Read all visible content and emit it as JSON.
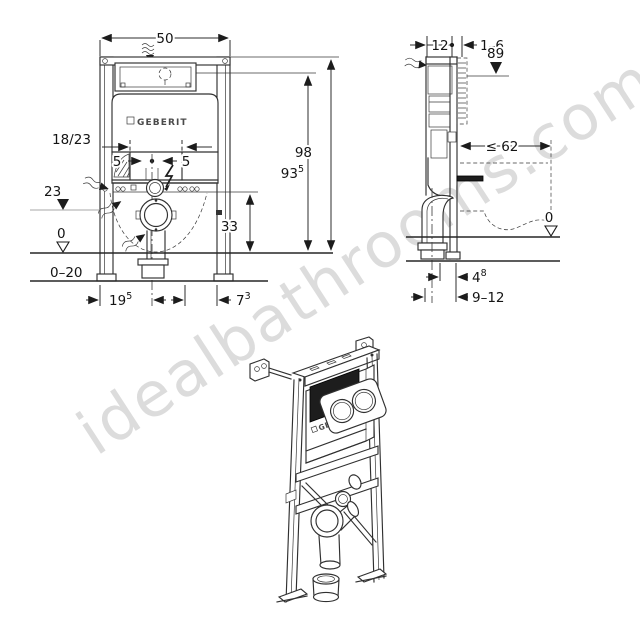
{
  "watermark": {
    "text": "idealbathrooms.com"
  },
  "brand": {
    "logo": "GEBERIT"
  },
  "front_view": {
    "dim_width": "50",
    "dim_inlet_offset": "18/23",
    "dim_bolt_left": "5",
    "dim_bolt_right": "5",
    "dim_outlet_height": "23",
    "dim_fix_height": "33",
    "dim_floor_level": "0",
    "dim_adjust_range": "0–20",
    "dim_height_total": "98",
    "dim_height_plate_main": "93",
    "dim_height_plate_sup": "5",
    "dim_foot_left_main": "19",
    "dim_foot_left_sup": "5",
    "dim_foot_right_main": "7",
    "dim_foot_right_sup": "3"
  },
  "side_view": {
    "dim_depth": "12",
    "dim_wall_gap": "1–6",
    "dim_plate_height": "89",
    "dim_pan_depth": "≤ 62",
    "dim_floor_level": "0",
    "dim_outlet_main": "4",
    "dim_outlet_sup": "8",
    "dim_outlet_range": "9–12"
  }
}
